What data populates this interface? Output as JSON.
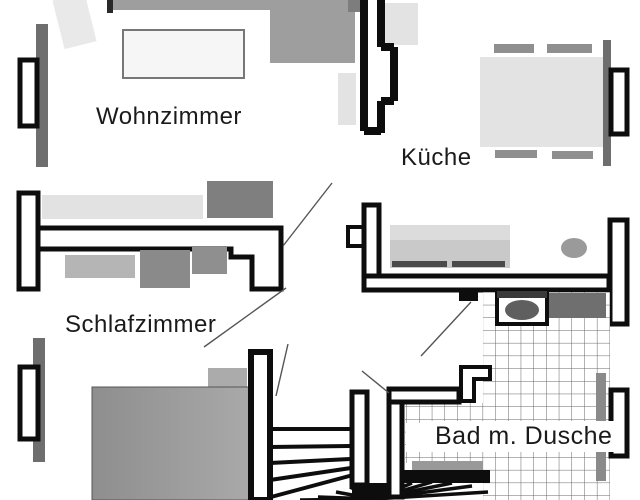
{
  "document": {
    "type": "floor-plan",
    "language": "de"
  },
  "rooms": [
    {
      "id": "wohnzimmer",
      "label": "Wohnzimmer"
    },
    {
      "id": "kueche",
      "label": "Küche"
    },
    {
      "id": "schlafzimmer",
      "label": "Schlafzimmer"
    },
    {
      "id": "bad",
      "label": "Bad m. Dusche"
    }
  ],
  "features": {
    "window_count": 4,
    "staircase": "winder-staircase-bottom-center",
    "furniture": [
      "sofa",
      "coffee-table",
      "dining-table",
      "chairs",
      "kitchen-counter",
      "sink",
      "washing-machine",
      "bed",
      "wardrobe",
      "dresser",
      "tiled-shower-floor"
    ]
  },
  "colors": {
    "background": "#ffffff",
    "wall": "#0d0d0d",
    "furniture_light": "#e3e3e3",
    "furniture_medium": "#9e9e9e",
    "furniture_dark": "#6f6f6f",
    "window_bar": "#6e6e6e",
    "tile_grid": "#666666",
    "leader_line": "#555555",
    "text": "#1a1a1a"
  }
}
